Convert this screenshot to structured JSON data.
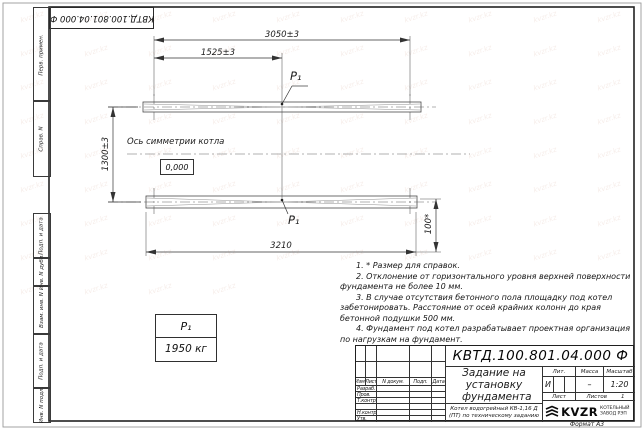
{
  "colors": {
    "line": "#333333",
    "background": "#ffffff"
  },
  "watermark": {
    "text": "kvzr.kz",
    "count": 84
  },
  "stamp_top": {
    "doc_number": "КВТД.100.801.04.000 Ф"
  },
  "side_strip": {
    "cells": [
      "Перв. примен.",
      "Справ. N",
      "Подп. и дата",
      "Инв. N дубл.",
      "Взам. инв. N",
      "Подп. и дата",
      "Инв. N подл."
    ]
  },
  "drawing": {
    "dim_top_overall": "3050±3",
    "dim_top_half": "1525±3",
    "dim_left_vertical": "1300±3",
    "dim_bottom_overall": "3210",
    "dim_right_height": "100*",
    "axis_label": "Ось симметрии котла",
    "level_mark": "0,000",
    "load_label_top": "Р₁",
    "load_label_bottom": "Р₁"
  },
  "load_table": {
    "name": "Р₁",
    "value": "1950 кг"
  },
  "notes": {
    "items": [
      "1. * Размер для справок.",
      "2. Отклонение от горизонтального уровня верхней поверхности фундамента не более 10 мм.",
      "3. В случае отсутствия бетонного пола площадку под котел забетонировать. Расстояние от осей крайних колонн до края бетонной подушки 500 мм.",
      "4. Фундамент под котел разрабатывает проектная организация по нагрузкам на фундамент."
    ]
  },
  "title_block": {
    "doc_number": "КВТД.100.801.04.000  Ф",
    "title": "Задание на установку фундамента",
    "product": "Котел водогрейный КВ-1,16 Д (ПТ) по техническому заданию",
    "header_cols": [
      "Изм.",
      "Лист",
      "N докум.",
      "Подп.",
      "Дата"
    ],
    "sign_rows": [
      "Разраб.",
      "Пров.",
      "Т.контр.",
      "",
      "Н.контр.",
      "Утв."
    ],
    "lit_label": "Лит.",
    "lit_value": "И",
    "mass_label": "Масса",
    "mass_value": "–",
    "scale_label": "Масштаб",
    "scale_value": "1:20",
    "sheet_label": "Лист",
    "sheets_label": "Листов",
    "sheets_value": "1",
    "company_logo": "KVZR",
    "company_name_line1": "КОТЕЛЬНЫЙ",
    "company_name_line2": "ЗАВОД РЭП",
    "format_label": "Формат А3"
  }
}
